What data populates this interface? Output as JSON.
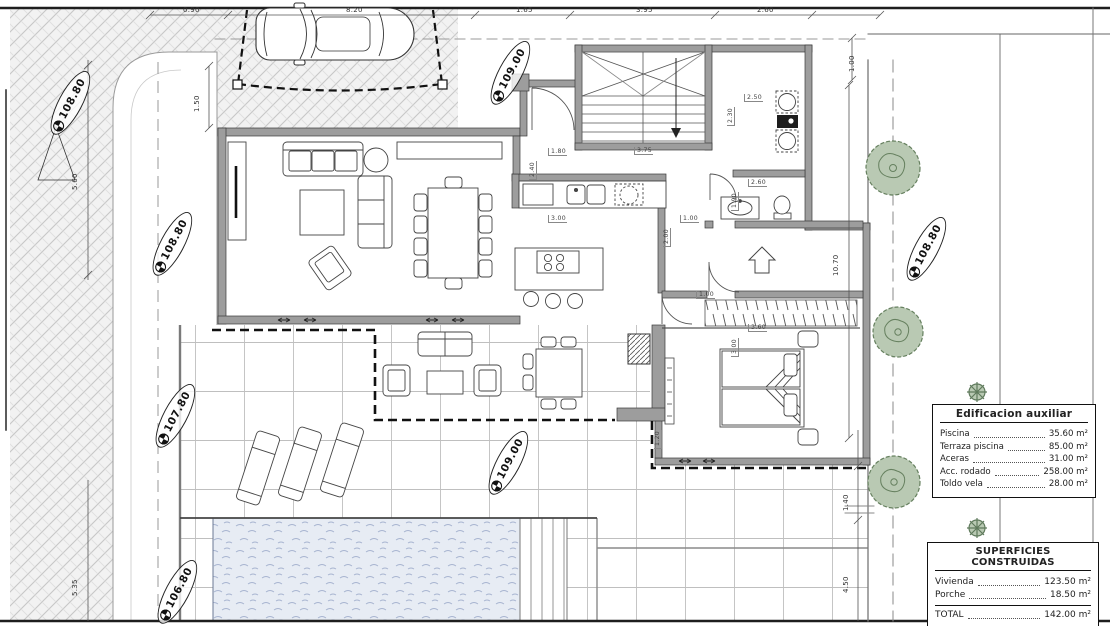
{
  "title": "Villa floor plan",
  "legend_auxiliary": {
    "title": "Edificacion auxiliar",
    "rows": [
      {
        "label": "Piscina",
        "value": "35.60 m²"
      },
      {
        "label": "Terraza piscina",
        "value": "85.00 m²"
      },
      {
        "label": "Aceras",
        "value": "31.00 m²"
      },
      {
        "label": "Acc. rodado",
        "value": "258.00 m²"
      },
      {
        "label": "Toldo vela",
        "value": "28.00 m²"
      }
    ]
  },
  "legend_built": {
    "title": "SUPERFICIES CONSTRUIDAS",
    "rows": [
      {
        "label": "Vivienda",
        "value": "123.50 m²"
      },
      {
        "label": "Porche",
        "value": "18.50 m²"
      }
    ],
    "total": {
      "label": "TOTAL",
      "value": "142.00 m²"
    }
  },
  "markers": [
    {
      "value": "108.80"
    },
    {
      "value": "108.80"
    },
    {
      "value": "107.80"
    },
    {
      "value": "106.80"
    },
    {
      "value": "109.00"
    },
    {
      "value": "109.00"
    },
    {
      "value": "108.80"
    }
  ],
  "dims": {
    "top": [
      "0.90",
      "8.20",
      "1.65",
      "3.95",
      "2.60"
    ],
    "right": [
      "1.00",
      "10.70",
      "1.40",
      "4.50"
    ],
    "left": [
      "1.50",
      "5.60",
      "5.35"
    ],
    "interior": [
      "1.80",
      "3.75",
      "2.40",
      "3.00",
      "1.00",
      "2.00",
      "2.50",
      "2.30",
      "2.60",
      "1.90",
      "1.00",
      "3.60",
      "3.00",
      "1.20"
    ]
  }
}
